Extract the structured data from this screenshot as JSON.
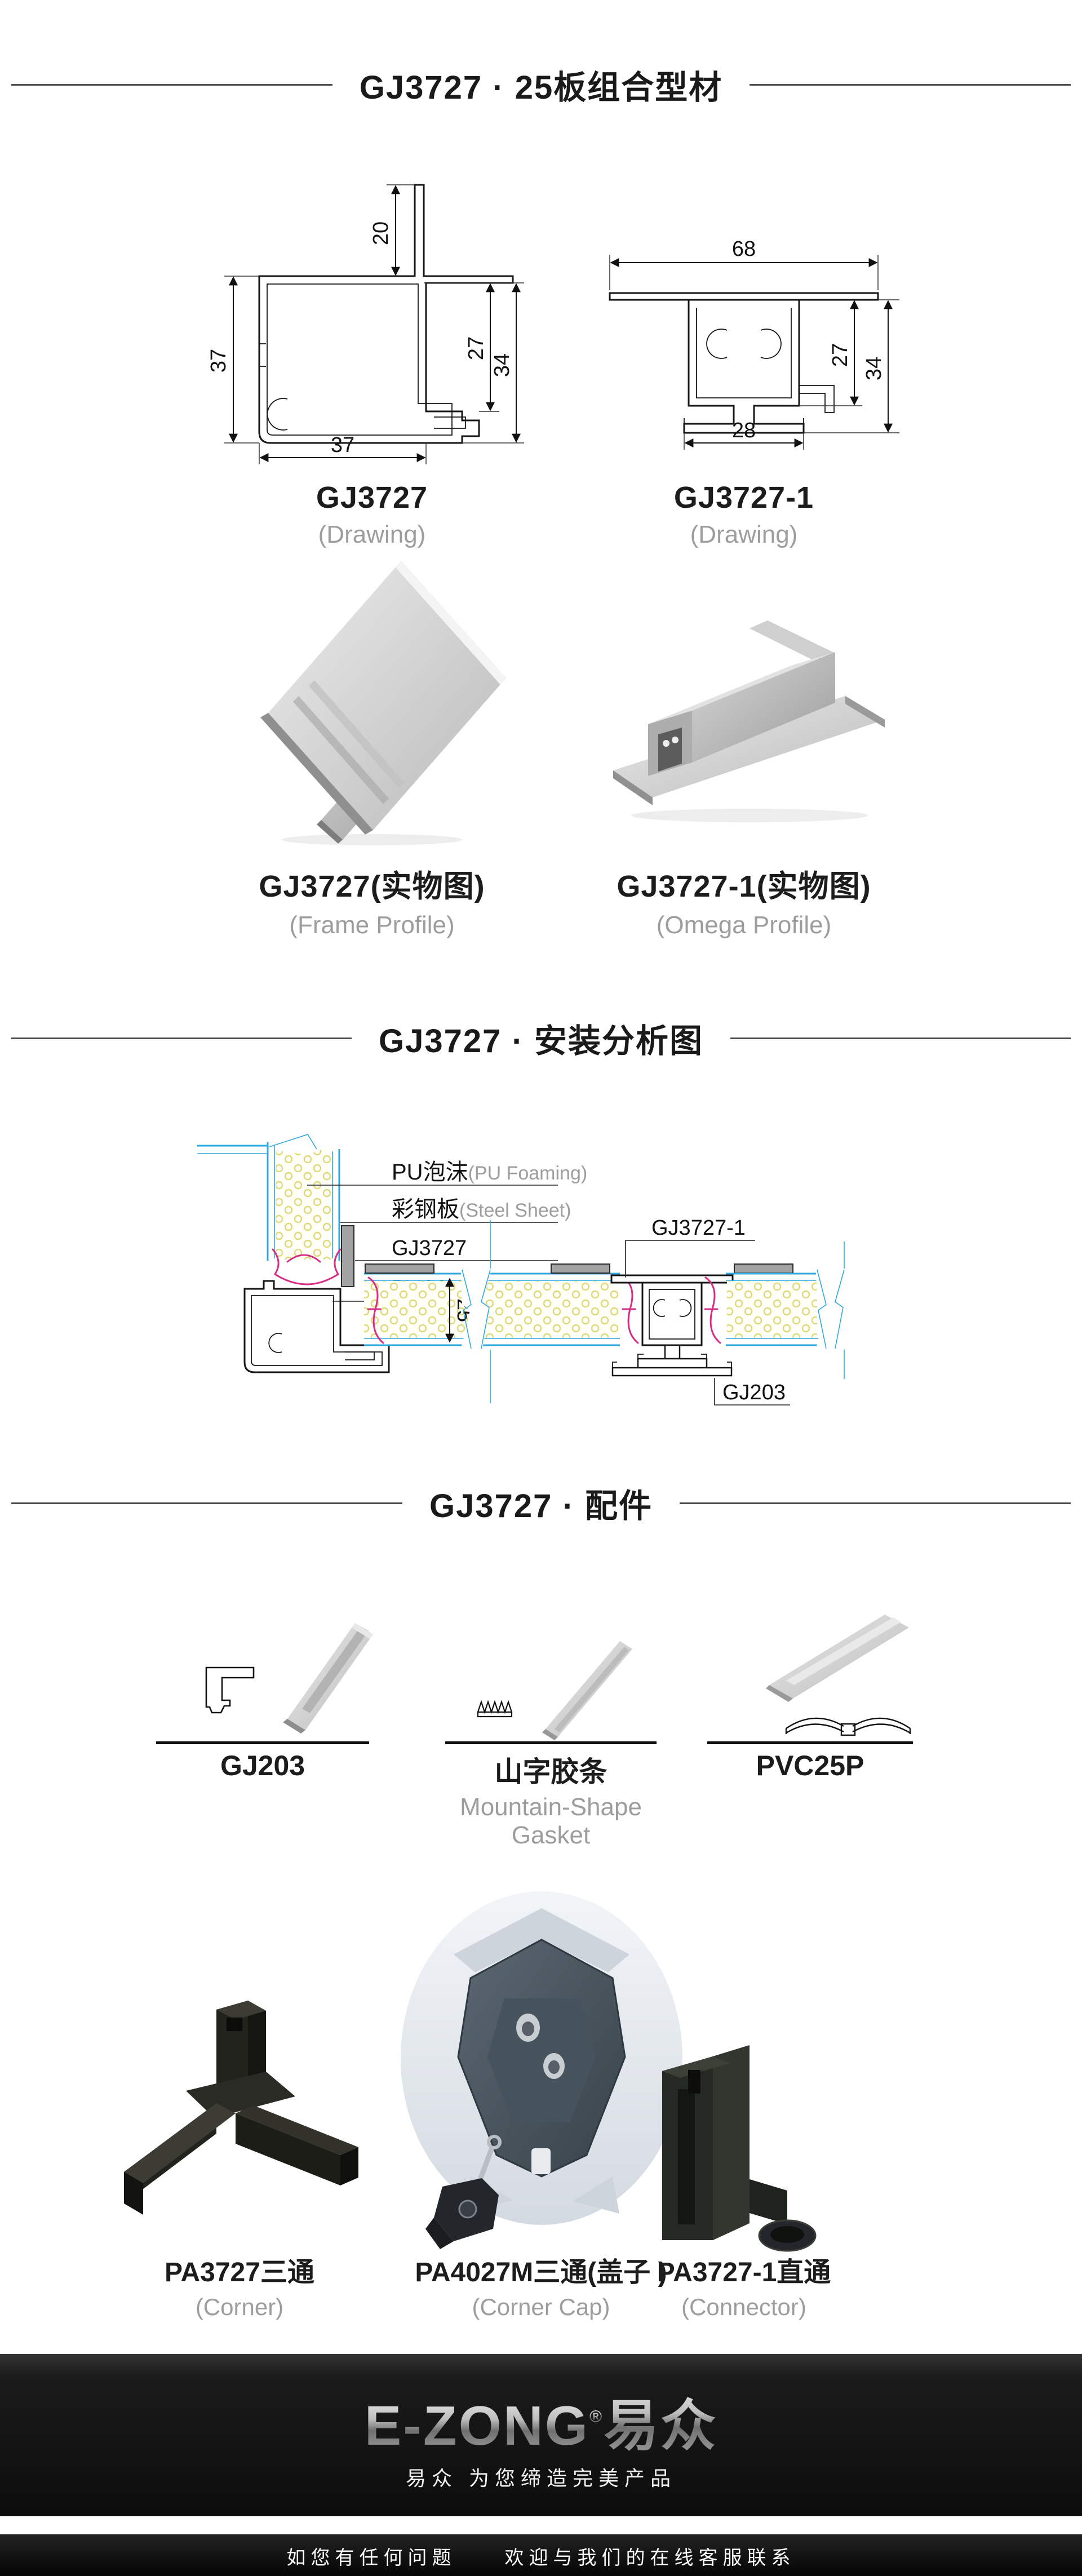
{
  "theme": {
    "ink": "#1a1a1a",
    "graytext": "#9d9d9d",
    "rule": "#4d4d4d",
    "cyan": "#2fa9dd",
    "foam": "#deda7c",
    "gasket": "#d62e85",
    "capgray": "#a3a3a3"
  },
  "headers": {
    "h1": "GJ3727 · 25板组合型材",
    "h2": "GJ3727 · 安装分析图",
    "h3": "GJ3727 · 配件"
  },
  "drawings": {
    "gj3727": {
      "name": "GJ3727",
      "sub": "(Drawing)",
      "dims": {
        "top": "20",
        "left": "37",
        "right_inner": "27",
        "right_outer": "34",
        "bottom": "37"
      }
    },
    "gj3727_1": {
      "name": "GJ3727-1",
      "sub": "(Drawing)",
      "dims": {
        "top": "68",
        "right_inner": "27",
        "right_outer": "34",
        "bottom": "28"
      }
    }
  },
  "photos": {
    "gj3727": {
      "name": "GJ3727(实物图)",
      "sub": "(Frame Profile)"
    },
    "gj3727_1": {
      "name": "GJ3727-1(实物图)",
      "sub": "(Omega Profile)"
    }
  },
  "install": {
    "labels": {
      "pu_cn": "PU泡沫",
      "pu_en": "(PU Foaming)",
      "steel_cn": "彩钢板",
      "steel_en": "(Steel Sheet)",
      "gj3727": "GJ3727",
      "pvc25p": "PVC25P",
      "gj3727_1": "GJ3727-1",
      "gj203": "GJ203",
      "thickness": "25"
    }
  },
  "accessories": [
    {
      "name": "GJ203",
      "sub": ""
    },
    {
      "name": "山字胶条",
      "sub": "Mountain-Shape Gasket"
    },
    {
      "name": "PVC25P",
      "sub": ""
    }
  ],
  "connectors": [
    {
      "name": "PA3727三通",
      "sub": "(Corner)"
    },
    {
      "name": "PA4027M三通(盖子 )",
      "sub": "(Corner Cap)"
    },
    {
      "name": "PA3727-1直通",
      "sub": "(Connector)"
    }
  ],
  "footer": {
    "logo": "E-ZONG",
    "logo_reg": "®",
    "logo_cn": "易众",
    "slogan": "易众 为您缔造完美产品",
    "contact": "如您有任何问题　　欢迎与我们的在线客服联系"
  }
}
